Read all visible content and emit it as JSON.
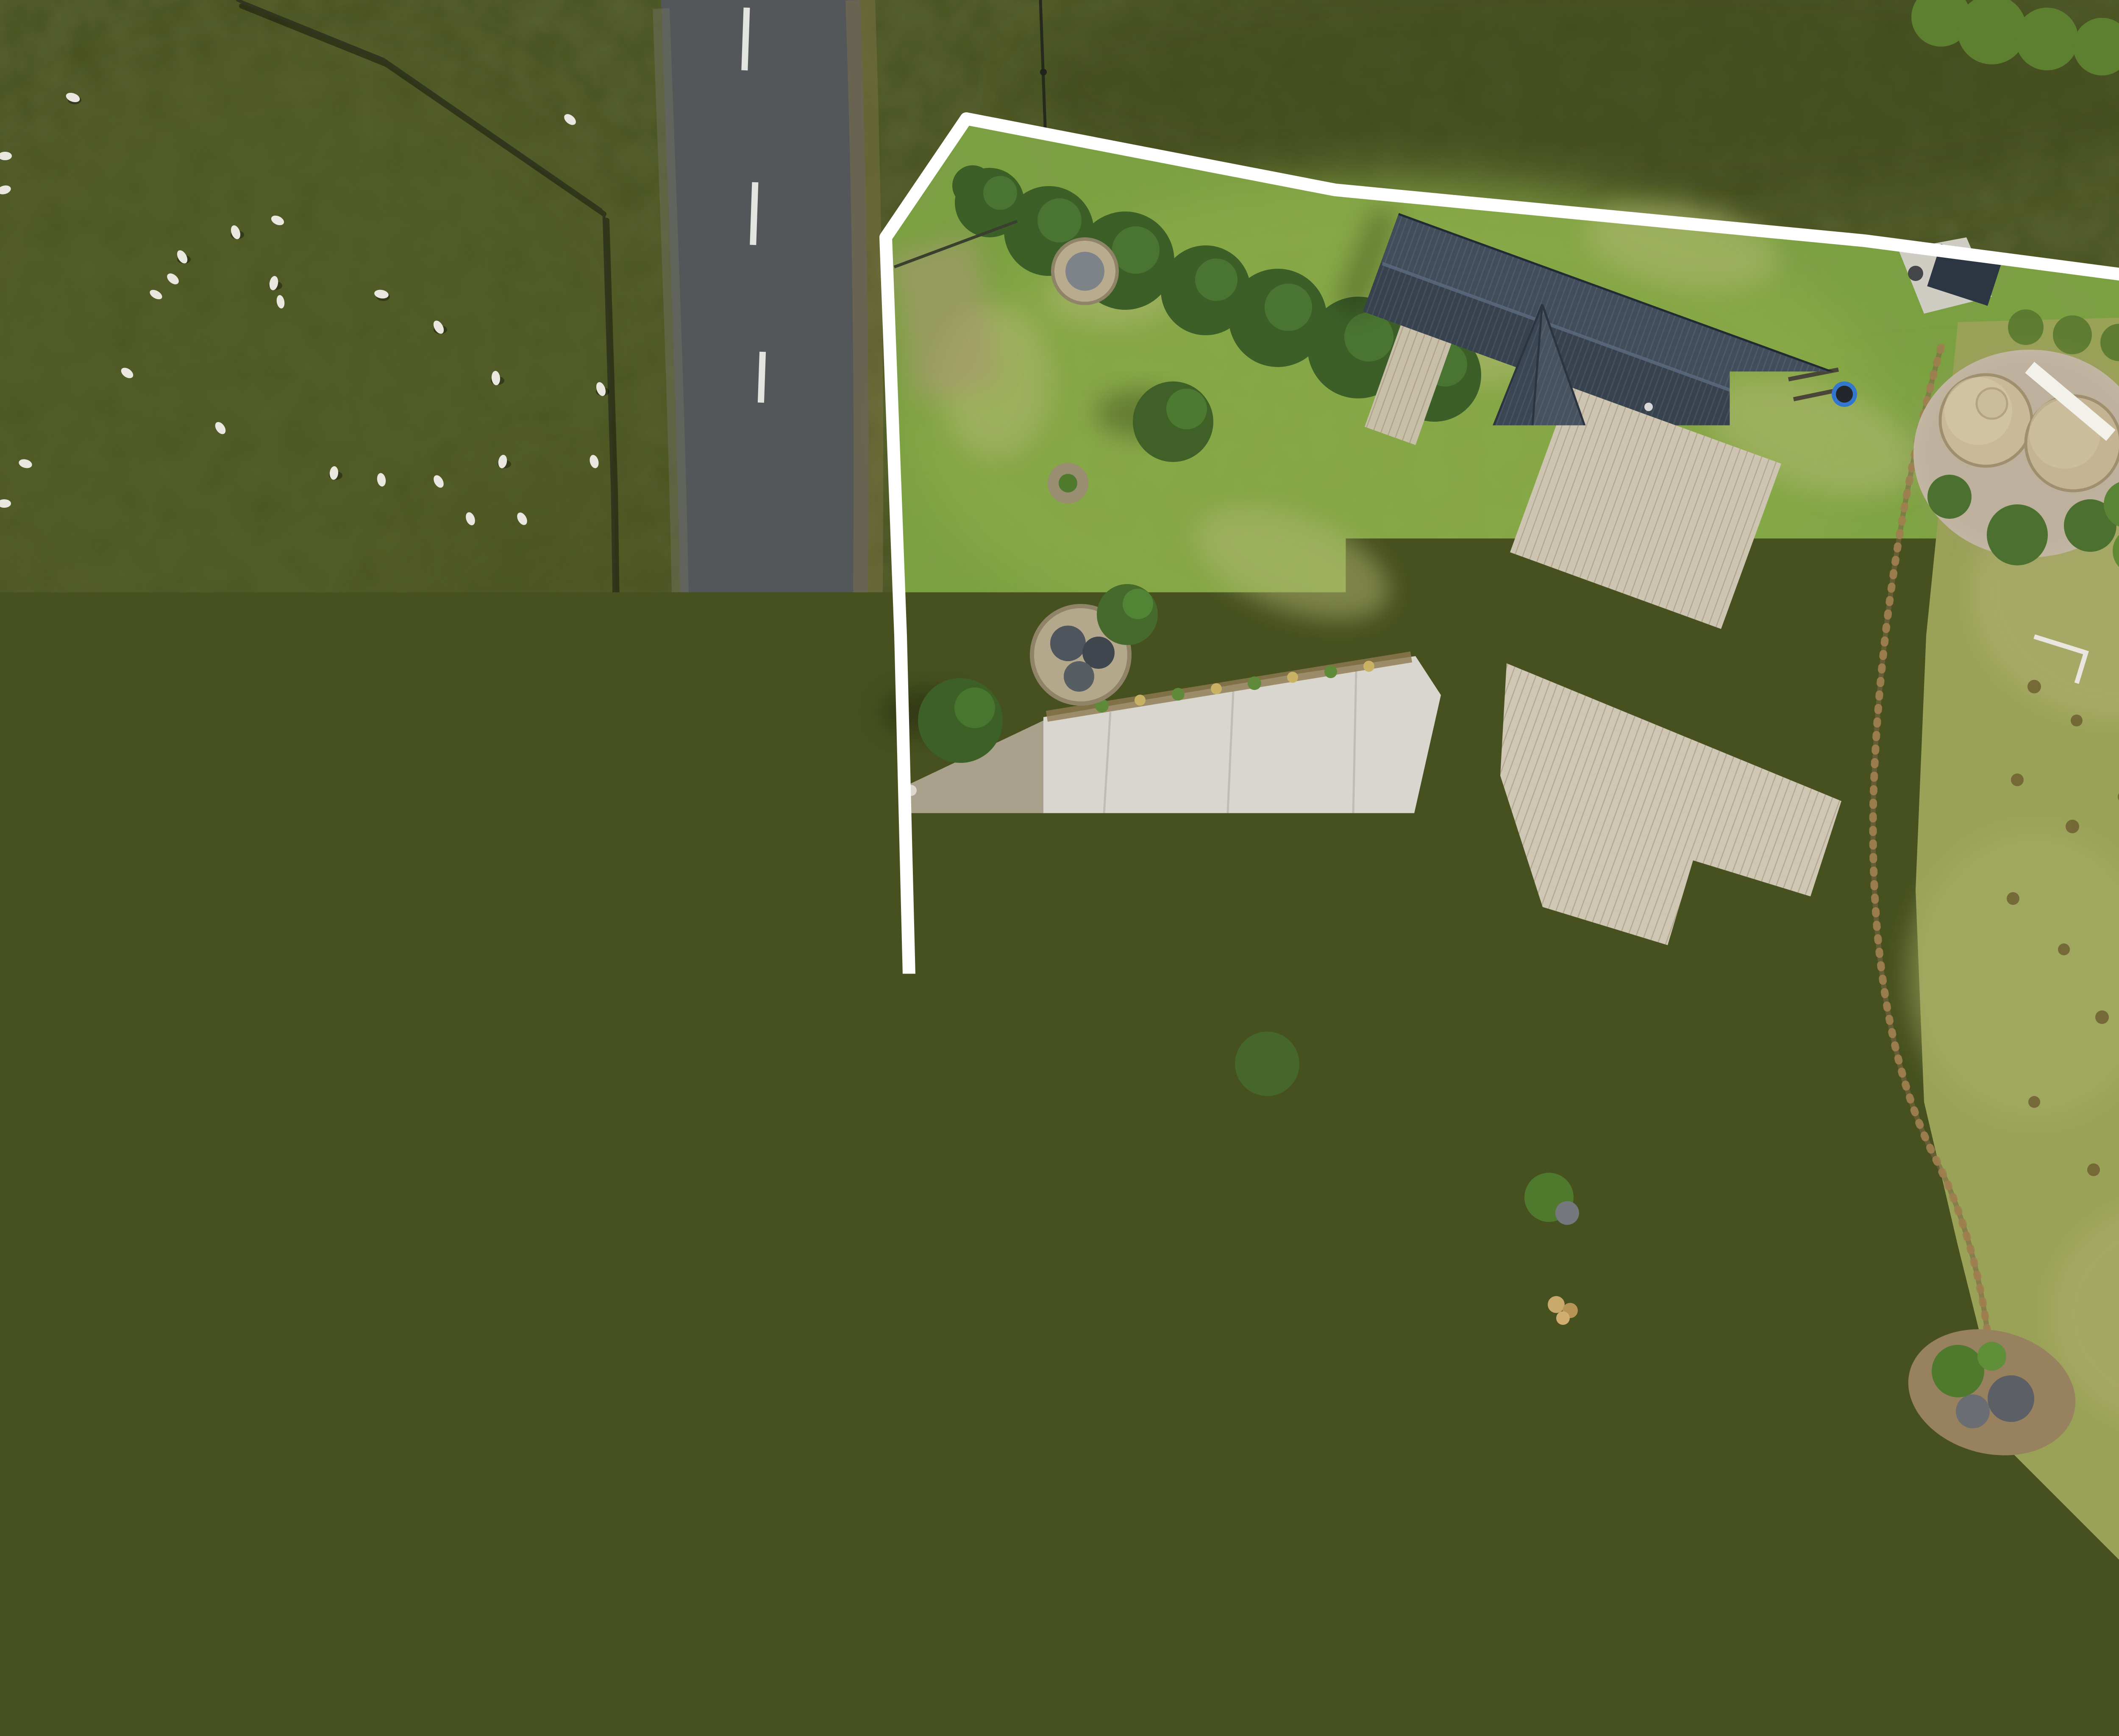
{
  "caption": {
    "text": "Boundary lines are indicative only",
    "color": "#ffffff"
  },
  "scene": {
    "kind": "aerial-drone-photo-with-boundary-overlay",
    "boundary_line_color": "#ffffff",
    "palette": {
      "paddock_dark": "#47511f",
      "lawn_green": "#7aa23f",
      "dry_grass": "#b6ae76",
      "rough_pasture": "#99a257",
      "road_asphalt": "#54575a",
      "concrete": "#d8d6ce",
      "gravel": "#a9a18b",
      "roof_slate": "#38424e",
      "deck_wood": "#cdc4b2",
      "solar_panel": "#16224a",
      "trampoline_blue": "#3d8ade",
      "pond_brown": "#7b5c38",
      "pond_gray": "#68776e",
      "tree_dark": "#22301a",
      "sheep_white": "#e9e7df"
    },
    "counts": {
      "sheep": 26,
      "water_tanks": 2,
      "solar_arrays": 2,
      "fire_pits": 3
    }
  }
}
